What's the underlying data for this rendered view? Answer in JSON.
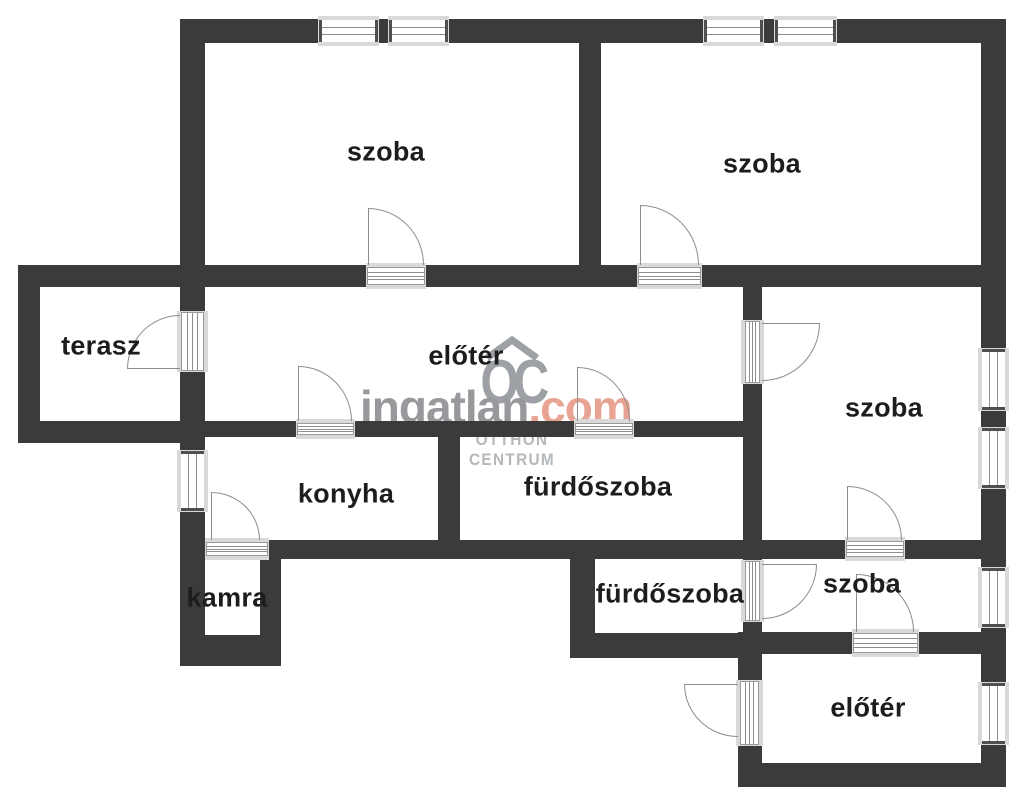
{
  "rooms": [
    {
      "id": "szoba-top-left",
      "label": "szoba"
    },
    {
      "id": "szoba-top-right",
      "label": "szoba"
    },
    {
      "id": "terasz",
      "label": "terasz"
    },
    {
      "id": "eloter-main",
      "label": "előtér"
    },
    {
      "id": "szoba-right",
      "label": "szoba"
    },
    {
      "id": "konyha",
      "label": "konyha"
    },
    {
      "id": "furdoszoba-upper",
      "label": "fürdőszoba"
    },
    {
      "id": "kamra",
      "label": "kamra"
    },
    {
      "id": "furdoszoba-lower",
      "label": "fürdőszoba"
    },
    {
      "id": "szoba-lower",
      "label": "szoba"
    },
    {
      "id": "eloter-bottom",
      "label": "előtér"
    }
  ],
  "watermark": {
    "brand": "ingatlan",
    "tld": ".com",
    "monogram": "OC",
    "org_line1": "OTTHON",
    "org_line2": "CENTRUM"
  },
  "colors": {
    "wall": "#3b3b3b",
    "bg": "#ffffff",
    "frame": "#d9d9d9",
    "frameline": "#8d8d8d",
    "arc": "#8d8d8d",
    "label": "#1d1d1d",
    "wmgray": "#97999d",
    "wmsalmon": "#e9a392",
    "wmlogo": "#9da0a4",
    "wmlight": "#b5b8bb"
  }
}
